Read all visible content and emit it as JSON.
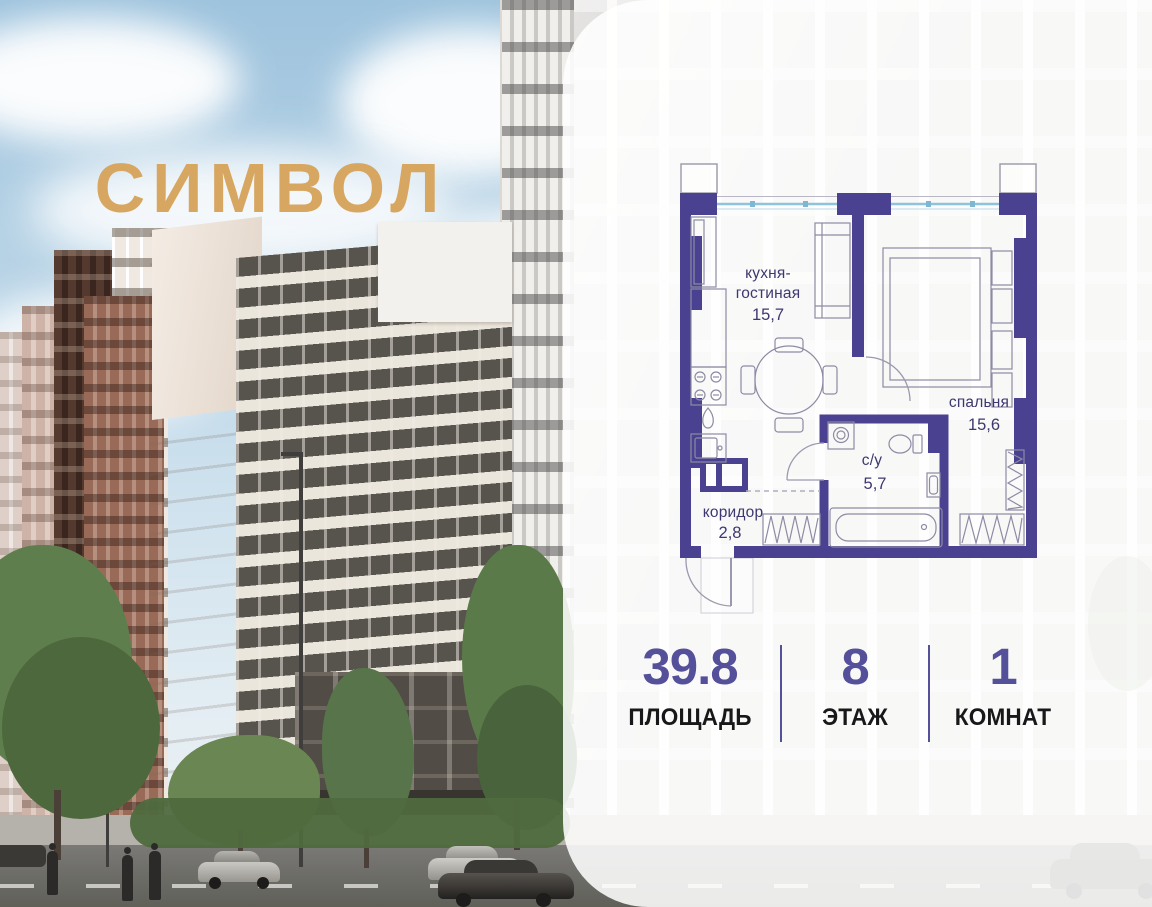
{
  "brand": {
    "logo_text": "СИМВОЛ",
    "logo_color": "#D7A660"
  },
  "floor_plan": {
    "wall_color": "#4A4290",
    "label_color": "#3D3870",
    "window_color": "#8FC3DC",
    "rooms": [
      {
        "id": "kitchen-living",
        "label_line1": "кухня-",
        "label_line2": "гостиная",
        "area": "15,7"
      },
      {
        "id": "bedroom",
        "label": "спальня",
        "area": "15,6"
      },
      {
        "id": "bathroom",
        "label": "с/у",
        "area": "5,7"
      },
      {
        "id": "corridor",
        "label": "коридор",
        "area": "2,8"
      }
    ]
  },
  "stats": {
    "accent_color": "#55509A",
    "items": [
      {
        "value": "39.8",
        "label": "ПЛОЩАДЬ"
      },
      {
        "value": "8",
        "label": "ЭТАЖ"
      },
      {
        "value": "1",
        "label": "КОМНАТ"
      }
    ]
  }
}
